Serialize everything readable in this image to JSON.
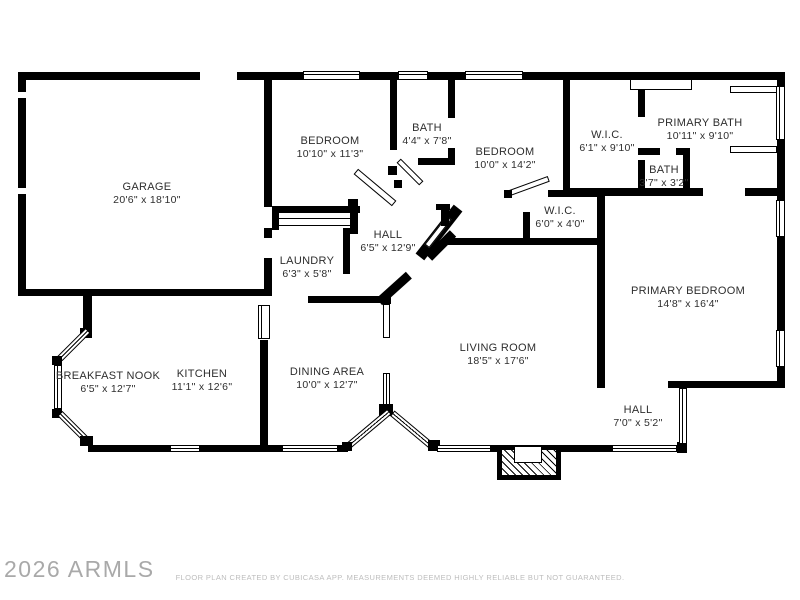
{
  "meta": {
    "watermark": "2026 ARMLS",
    "disclaimer": "FLOOR PLAN CREATED BY CUBICASA APP. MEASUREMENTS DEEMED HIGHLY RELIABLE BUT NOT GUARANTEED."
  },
  "floor_plan": {
    "colors": {
      "wall": "#000000",
      "background": "#ffffff",
      "label_text": "#2e2e2e",
      "watermark_text": "#a9a9a9",
      "disclaimer_text": "#bdbdbd"
    },
    "rooms": [
      {
        "name": "GARAGE",
        "dims": "20'6\" x 18'10\""
      },
      {
        "name": "BEDROOM",
        "dims": "10'10\" x 11'3\""
      },
      {
        "name": "BATH",
        "dims": "4'4\" x 7'8\""
      },
      {
        "name": "BEDROOM",
        "dims": "10'0\" x 14'2\""
      },
      {
        "name": "W.I.C.",
        "dims": "6'1\" x 9'10\""
      },
      {
        "name": "PRIMARY BATH",
        "dims": "10'11\" x 9'10\""
      },
      {
        "name": "BATH",
        "dims": "3'7\" x 3'2\""
      },
      {
        "name": "HALL",
        "dims": "6'5\" x 12'9\""
      },
      {
        "name": "LAUNDRY",
        "dims": "6'3\" x 5'8\""
      },
      {
        "name": "W.I.C.",
        "dims": "6'0\" x 4'0\""
      },
      {
        "name": "PRIMARY BEDROOM",
        "dims": "14'8\" x 16'4\""
      },
      {
        "name": "LIVING ROOM",
        "dims": "18'5\" x 17'6\""
      },
      {
        "name": "BREAKFAST NOOK",
        "dims": "6'5\" x 12'7\""
      },
      {
        "name": "KITCHEN",
        "dims": "11'1\" x 12'6\""
      },
      {
        "name": "DINING AREA",
        "dims": "10'0\" x 12'7\""
      },
      {
        "name": "HALL",
        "dims": "7'0\" x 5'2\""
      }
    ]
  }
}
